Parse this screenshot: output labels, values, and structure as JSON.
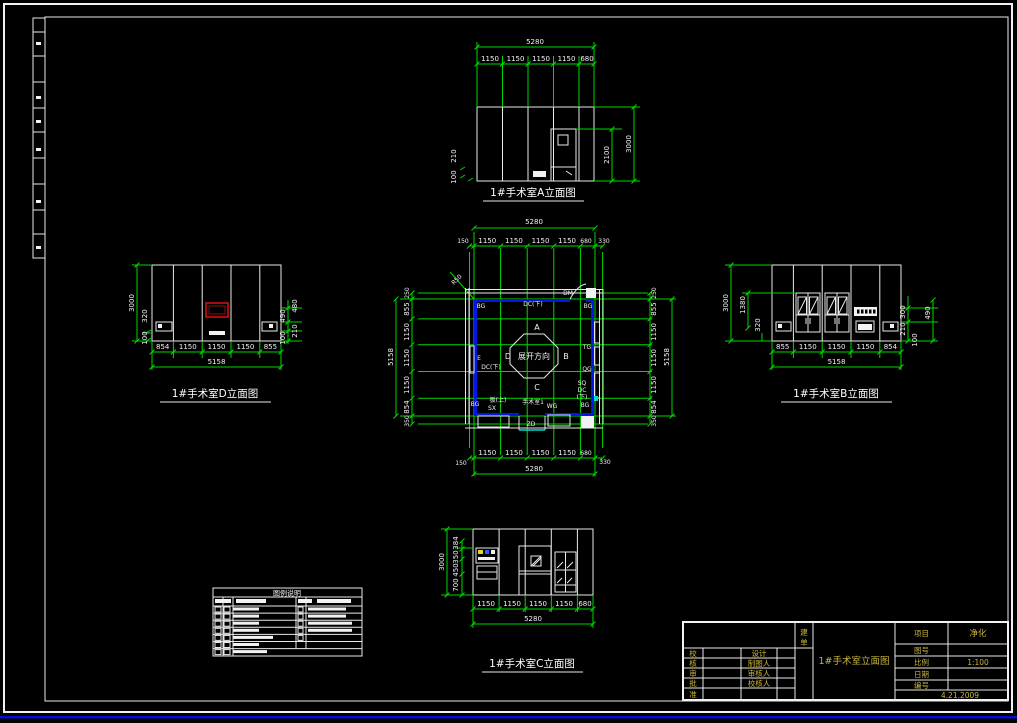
{
  "colors": {
    "background": "#000000",
    "dimension_green": "#00d900",
    "wall_blue": "#0018e0",
    "detail_cyan": "#00dcdc",
    "window_red": "#dd1111",
    "titleblock_yellow": "#c9b53e",
    "line_white": "#f2f2f2"
  },
  "elev_a": {
    "title": "1#手术室A立面图",
    "total": "5280",
    "segments": [
      "1150",
      "1150",
      "1150",
      "1150",
      "680"
    ],
    "door_height": "2100",
    "wall_height": "3000",
    "left_upper": "210",
    "left_lower": "100"
  },
  "elev_d": {
    "title": "1#手术室D立面图",
    "total": "5158",
    "segments": [
      "854",
      "1150",
      "1150",
      "1150",
      "855"
    ],
    "left": [
      "3000",
      "320",
      "100"
    ],
    "right": [
      "480",
      "490",
      "210",
      "100"
    ]
  },
  "elev_b": {
    "title": "1#手术室B立面图",
    "total": "5158",
    "segments": [
      "855",
      "1150",
      "1150",
      "1150",
      "854"
    ],
    "left": [
      "3000",
      "1380",
      "320"
    ],
    "right": [
      "300",
      "210",
      "490",
      "100"
    ]
  },
  "elev_c": {
    "title": "1#手术室C立面图",
    "total": "5280",
    "segments": [
      "1150",
      "1150",
      "1150",
      "1150",
      "680"
    ],
    "left": [
      "3000",
      "384",
      "350",
      "450",
      "700"
    ]
  },
  "plan": {
    "room_label": "手术室1",
    "octagon_label": "展开方向",
    "dir_top": "A",
    "dir_right": "B",
    "dir_bottom": "C",
    "dir_left": "D",
    "radius_note": "R50",
    "top_total": "5280",
    "top_segments": [
      "150",
      "1150",
      "1150",
      "1150",
      "1150",
      "680",
      "330"
    ],
    "bottom_total": "5280",
    "bottom_segments": [
      "150",
      "1150",
      "1150",
      "1150",
      "1150",
      "680",
      "330"
    ],
    "left_total": "5158",
    "left_segments": [
      "250",
      "855",
      "1150",
      "1150",
      "1150",
      "854",
      "350"
    ],
    "right_total": "5158",
    "right_segments": [
      "250",
      "855",
      "1150",
      "1150",
      "1150",
      "854",
      "350"
    ],
    "labels": {
      "dm": "DM",
      "bg_tl": "BG",
      "dc_top": "DC(下)",
      "bg_tr": "BG",
      "e": "E",
      "dc_left": "DC(下)",
      "tg": "TG",
      "qg": "QG",
      "sq": "SQ",
      "dc_r": "DC",
      "dc_r2": "(下)",
      "bg_br": "BG",
      "bg_bl": "BG",
      "ban_up": "板(上)",
      "sx": "SX",
      "wg": "WG",
      "zd": "ZD"
    }
  },
  "legend": {
    "title": "图例说明"
  },
  "titleblock": {
    "client_top": "建",
    "client_bottom": "单",
    "drawing_title": "1#手术室立面图",
    "project_label": "项目",
    "project_value": "净化",
    "drawing_no_label": "图号",
    "scale_label": "比例",
    "scale_value": "1:100",
    "date_label": "日期",
    "number_label": "编号",
    "date_value": "4.21.2009",
    "rows": [
      {
        "c": "校",
        "w": "设计"
      },
      {
        "c": "核",
        "w": "制图人"
      },
      {
        "c": "审",
        "w": "审核人"
      },
      {
        "c": "批",
        "w": "校核人"
      },
      {
        "c": "准",
        "w": ""
      }
    ]
  }
}
